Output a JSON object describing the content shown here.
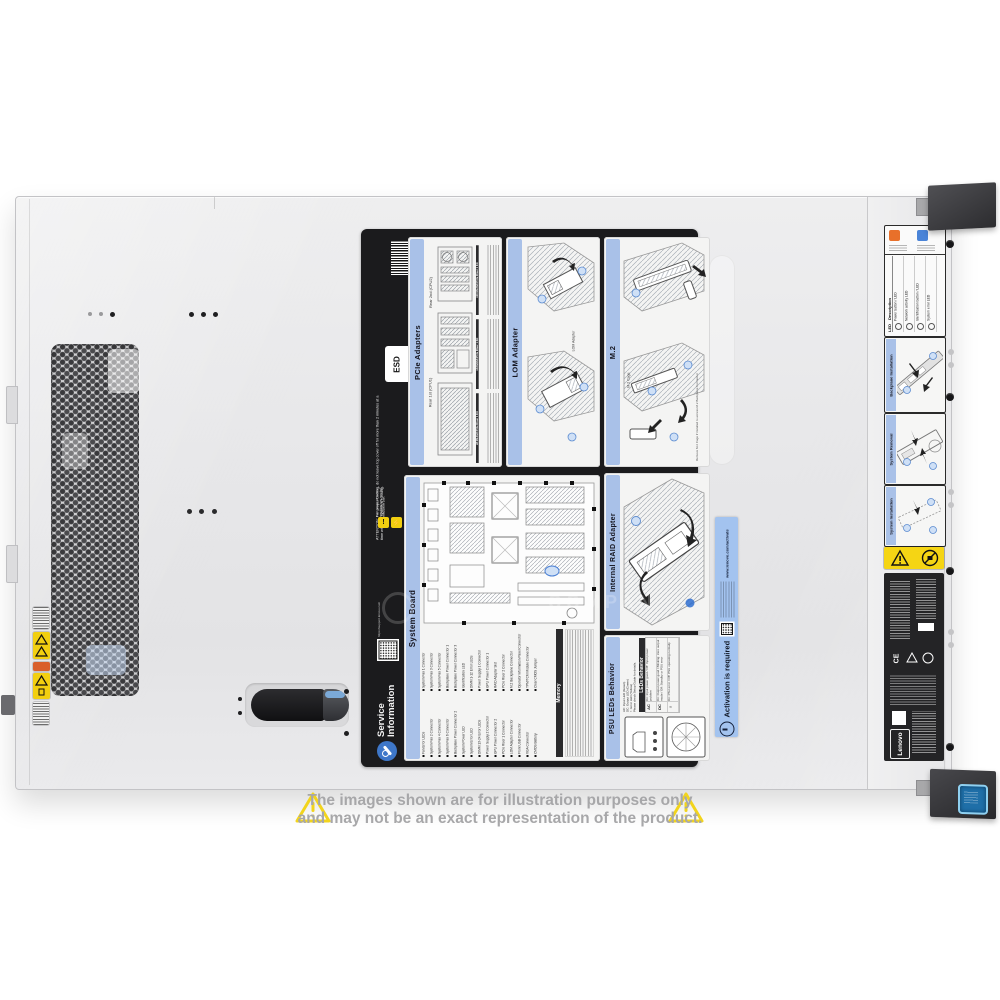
{
  "photo": {
    "watermark_text": "COMPAN",
    "disclaimer": {
      "line1": "The images shown are for illustration purposes only",
      "line2": "and may not be an exact representation of the product."
    }
  },
  "service_label": {
    "attention": "ATTENTION: For proper cooling, do not leave top cover off for more than 2 minutes at a time while the system is running.",
    "esd_label": "ESD",
    "pcie": {
      "title": "PCIe Adapters",
      "caption_rear1": "Rear 1st (CPU1)",
      "caption_rear2": "Rear 2nd (CPU2)",
      "riser_kits": [
        "x16/x8/x8 PCIe Riser 1 Kit",
        "x16 ML2/x8 PCIe Riser 1 Kit",
        "x8 ML2/x8 PCIe Riser 1 Kit"
      ]
    },
    "lom": {
      "title": "LOM Adapter",
      "caption": "LOM Adapter"
    },
    "m2": {
      "title": "M.2",
      "caption_cage": "M.2 Cage",
      "note": "Remove M.2 Cage if installed to access M.2 Backplane Connector"
    },
    "system_board": {
      "title": "System Board",
      "memory_title": "Memory",
      "legend": [
        "Fan Error LEDs",
        "System Fan 1 Connector",
        "System Fan 2 Connector",
        "System Fan 3 Connector",
        "System Fan 4 Connector",
        "System Fan 5 Connector",
        "System Fan 6 Connector",
        "Backplane Power Connector 1",
        "Backplane Power Connector 2",
        "Backplane Power Connector 3",
        "System Power LED",
        "Identification LED",
        "System Error LED",
        "DIMM 1-12 Error LEDs",
        "DIMM 13-24 Error LEDs",
        "Power Supply 1 Connector",
        "Power Supply 2 Connector",
        "GPU Power Connector 1",
        "GPU Power Connector 2",
        "RAID Adapter Slot",
        "PCIe Riser 1 Connector",
        "PCIe Riser 2 Connector",
        "LOM Adapter Connector",
        "M.2 Backplane Connector",
        "Front USB Connector",
        "Operator Information Panel Connector",
        "VGA Connector",
        "TPM/TCM Module Connector",
        "CMOS Battery",
        "Clear CMOS Jumper"
      ]
    },
    "raid": {
      "title": "Internal RAID Adapter"
    },
    "psu": {
      "title": "PSU LEDs Behavior",
      "legend": [
        "AC: Input LED (Green)",
        "DC: Output LED (Green)",
        "! : Error LED (Yellow)",
        "Please check Setup Guide for details."
      ],
      "table_title": "LEDs Behavior",
      "rows": [
        {
          "led": "AC",
          "desc": "On: Input power good / Off: Input power problem"
        },
        {
          "led": "DC",
          "desc": "On: Output power good / Blinking: Zero output mode / Off: Standby or PSU error"
        },
        {
          "led": "!",
          "desc": "On: PSU error / Off: PSU operating normally"
        }
      ]
    },
    "service_info": {
      "line1": "Service",
      "line2": "Information",
      "url": "https://support.lenovo.com",
      "warning": "Turn power off before removing any non-hot swappable part."
    }
  },
  "activation_label": {
    "title": "Activation is required",
    "url": "www.lenovo.com/activate"
  },
  "front_bezel": {
    "operator_panel": {
      "col_led": "LED",
      "col_desc": "Description",
      "rows": [
        "Power button / LED",
        "Network activity LED",
        "Identification button / LED",
        "System error LED"
      ]
    },
    "guides": [
      {
        "title": "Backplane Installation"
      },
      {
        "title": "System Removal"
      },
      {
        "title": "System Installation"
      }
    ],
    "brand": "Lenovo"
  },
  "colors": {
    "label_black": "#1b1b1d",
    "band_blue": "#a9c1e8",
    "activation_blue": "#a3c3ef",
    "warning_yellow": "#f2cf10",
    "disclaimer_yellow": "#f2d41c"
  }
}
